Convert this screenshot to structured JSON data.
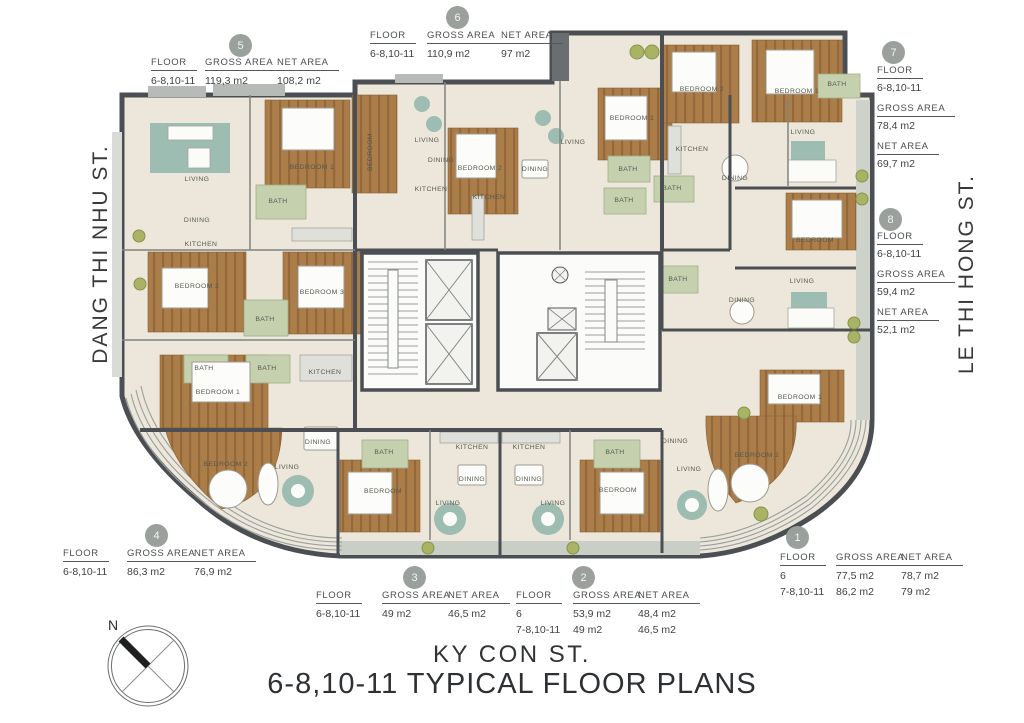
{
  "title": {
    "street_bottom": "KY CON ST.",
    "main": "6-8,10-11 TYPICAL FLOOR PLANS"
  },
  "streets": {
    "left": "DANG THI NHU ST.",
    "right": "LE THI HONG ST."
  },
  "compass": {
    "north_label": "N"
  },
  "table_headers": {
    "floor": "FLOOR",
    "gross": "GROSS AREA",
    "net": "NET AREA"
  },
  "units": {
    "u1": {
      "number": "1",
      "rows": [
        {
          "floor": "6",
          "gross": "77,5 m2",
          "net": "78,7 m2"
        },
        {
          "floor": "7-8,10-11",
          "gross": "86,2 m2",
          "net": "79 m2"
        }
      ]
    },
    "u2": {
      "number": "2",
      "rows": [
        {
          "floor": "6",
          "gross": "53,9 m2",
          "net": "48,4 m2"
        },
        {
          "floor": "7-8,10-11",
          "gross": "49 m2",
          "net": "46,5 m2"
        }
      ]
    },
    "u3": {
      "number": "3",
      "rows": [
        {
          "floor": "6-8,10-11",
          "gross": "49 m2",
          "net": "46,5 m2"
        }
      ]
    },
    "u4": {
      "number": "4",
      "rows": [
        {
          "floor": "6-8,10-11",
          "gross": "86,3 m2",
          "net": "76,9 m2"
        }
      ]
    },
    "u5": {
      "number": "5",
      "rows": [
        {
          "floor": "6-8,10-11",
          "gross": "119,3 m2",
          "net": "108,2 m2"
        }
      ]
    },
    "u6": {
      "number": "6",
      "rows": [
        {
          "floor": "6-8,10-11",
          "gross": "110,9 m2",
          "net": "97 m2"
        }
      ]
    },
    "u7": {
      "number": "7",
      "floor": "6-8,10-11",
      "gross": "78,4 m2",
      "net": "69,7 m2"
    },
    "u8": {
      "number": "8",
      "floor": "6-8,10-11",
      "gross": "59,4 m2",
      "net": "52,1 m2"
    }
  },
  "plan": {
    "colors": {
      "wall": "#4b4f53",
      "floor": "#ece7da",
      "wood": "#aa7d49",
      "teal": "#9dbcb2",
      "bath": "#c5d1ae",
      "terrace": "#cdd2cb",
      "shrub": "#a8b464"
    },
    "room_labels": [
      {
        "t": "LIVING",
        "x": 197,
        "y": 181
      },
      {
        "t": "DINING",
        "x": 197,
        "y": 222
      },
      {
        "t": "KITCHEN",
        "x": 201,
        "y": 246
      },
      {
        "t": "BEDROOM 1",
        "x": 312,
        "y": 169
      },
      {
        "t": "BATH",
        "x": 278,
        "y": 203
      },
      {
        "t": "BEDROOM 2",
        "x": 197,
        "y": 288
      },
      {
        "t": "BEDROOM 3",
        "x": 322,
        "y": 294
      },
      {
        "t": "BATH",
        "x": 265,
        "y": 321
      },
      {
        "t": "LIVING",
        "x": 427,
        "y": 142
      },
      {
        "t": "DINING",
        "x": 441,
        "y": 162
      },
      {
        "t": "KITCHEN",
        "x": 431,
        "y": 191
      },
      {
        "t": "BEDROOM 2",
        "x": 480,
        "y": 170
      },
      {
        "t": "KITCHEN",
        "x": 489,
        "y": 199
      },
      {
        "t": "DINING",
        "x": 535,
        "y": 171
      },
      {
        "t": "LIVING",
        "x": 573,
        "y": 144
      },
      {
        "t": "BEDROOM 1",
        "x": 632,
        "y": 120
      },
      {
        "t": "BATH",
        "x": 628,
        "y": 171
      },
      {
        "t": "BATH",
        "x": 624,
        "y": 202
      },
      {
        "t": "BEDROOM 2",
        "x": 702,
        "y": 91
      },
      {
        "t": "BEDROOM 1",
        "x": 797,
        "y": 93
      },
      {
        "t": "BATH",
        "x": 837,
        "y": 86
      },
      {
        "t": "LIVING",
        "x": 803,
        "y": 134
      },
      {
        "t": "KITCHEN",
        "x": 692,
        "y": 151
      },
      {
        "t": "DINING",
        "x": 735,
        "y": 180
      },
      {
        "t": "BATH",
        "x": 672,
        "y": 190
      },
      {
        "t": "BEDROOM",
        "x": 815,
        "y": 242
      },
      {
        "t": "LIVING",
        "x": 802,
        "y": 283
      },
      {
        "t": "DINING",
        "x": 742,
        "y": 302
      },
      {
        "t": "BATH",
        "x": 678,
        "y": 281
      },
      {
        "t": "BATH",
        "x": 204,
        "y": 370
      },
      {
        "t": "BATH",
        "x": 267,
        "y": 370
      },
      {
        "t": "KITCHEN",
        "x": 325,
        "y": 374
      },
      {
        "t": "BEDROOM 1",
        "x": 218,
        "y": 394
      },
      {
        "t": "DINING",
        "x": 318,
        "y": 444
      },
      {
        "t": "BEDROOM 2",
        "x": 226,
        "y": 466
      },
      {
        "t": "LIVING",
        "x": 287,
        "y": 469
      },
      {
        "t": "BATH",
        "x": 384,
        "y": 454
      },
      {
        "t": "KITCHEN",
        "x": 472,
        "y": 449
      },
      {
        "t": "DINING",
        "x": 472,
        "y": 481
      },
      {
        "t": "BEDROOM",
        "x": 383,
        "y": 493
      },
      {
        "t": "LIVING",
        "x": 448,
        "y": 505
      },
      {
        "t": "BATH",
        "x": 615,
        "y": 454
      },
      {
        "t": "KITCHEN",
        "x": 529,
        "y": 449
      },
      {
        "t": "DINING",
        "x": 529,
        "y": 481
      },
      {
        "t": "BEDROOM",
        "x": 618,
        "y": 492
      },
      {
        "t": "LIVING",
        "x": 553,
        "y": 505
      },
      {
        "t": "BEDROOM 1",
        "x": 800,
        "y": 399
      },
      {
        "t": "BEDROOM 2",
        "x": 757,
        "y": 457
      },
      {
        "t": "DINING",
        "x": 675,
        "y": 443
      },
      {
        "t": "LIVING",
        "x": 689,
        "y": 471
      },
      {
        "t": "BEDROOM",
        "x": 372,
        "y": 152,
        "r": -90
      }
    ]
  }
}
